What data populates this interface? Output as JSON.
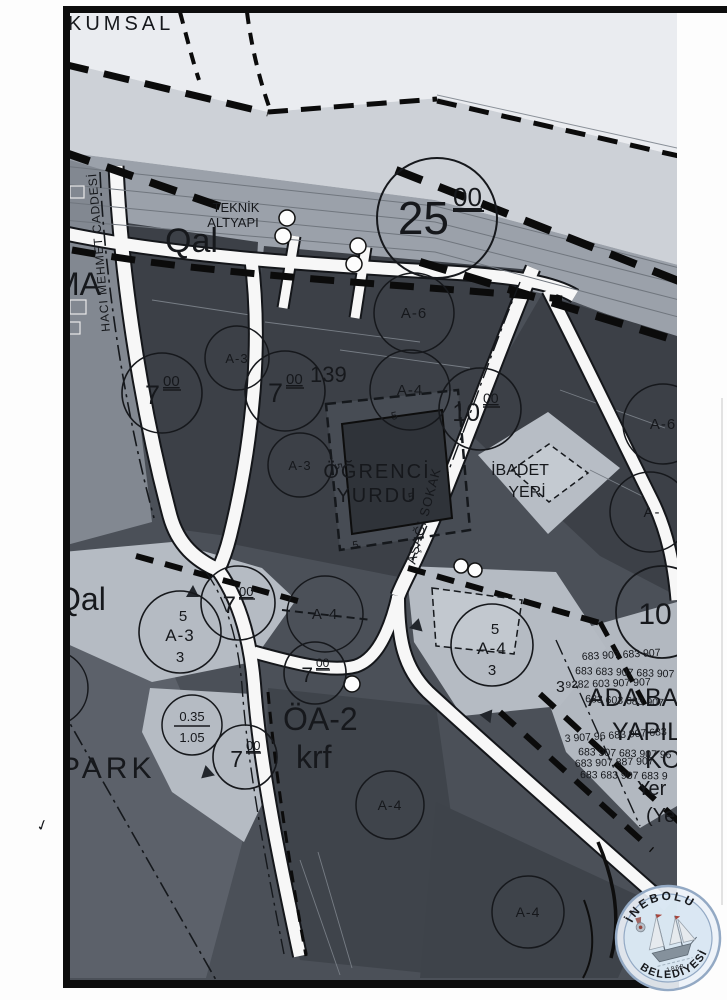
{
  "palette": {
    "sea": "#eaecf0",
    "shore": "#cdd1d7",
    "road_band": "#9ba1aa",
    "fabric_dark": "#4b5058",
    "block_dark": "#3c4047",
    "parcel_light": "#b5bbc3",
    "road_white": "#f7f7f7",
    "ink": "#16181c",
    "stamp_blue": "#3f68a8",
    "stamp_fill": "#d7e5f2"
  },
  "map": {
    "area_labels": {
      "kumsal": "KUMSAL",
      "ma": "MA",
      "qal_top": "Qal",
      "qal_left": "Qal",
      "teknik_1": "TEKNİK",
      "teknik_2": "ALTYAPI",
      "block_no": "139",
      "dorm_1": "ÖĞRENCİ",
      "dorm_2": "YURDU",
      "ibadet_1": "İBADET",
      "ibadet_2": "YERİ",
      "park": "PARK",
      "oa2": "ÖA-2",
      "krf": "krf",
      "ada_1": "ADA BA",
      "ada_2": "YAPIL",
      "ada_3": "KO",
      "yer_1": "Yer",
      "yer_2": "(Ye"
    },
    "street_labels": {
      "haci_mehmet": "HACI MEHMET CADDESİ",
      "asagi_sokak": "AŞAĞI SOKAK"
    },
    "circles": {
      "width": [
        {
          "main": "25",
          "sup": "00"
        },
        {
          "main": "7",
          "sup": "00"
        },
        {
          "main": "7",
          "sup": "00"
        },
        {
          "main": "10",
          "sup": "00"
        },
        {
          "main": "7",
          "sup": "00"
        },
        {
          "main": "7",
          "sup": "00"
        },
        {
          "main": "7",
          "sup": "00"
        },
        {
          "main": "10",
          "sup": ""
        }
      ],
      "parcel": [
        {
          "label": "A-3"
        },
        {
          "label": "A-3"
        },
        {
          "label": "A-6"
        },
        {
          "label": "A-4"
        },
        {
          "label": "A-6"
        },
        {
          "label": "A-"
        },
        {
          "label": "A-4"
        },
        {
          "label": "A-4"
        },
        {
          "label": "A-4"
        },
        {
          "label": "2"
        }
      ],
      "stack": [
        {
          "top": "5",
          "mid": "A-3",
          "bot": "3"
        },
        {
          "top": "5",
          "mid": "A-4",
          "bot": "3"
        }
      ],
      "ratio": [
        {
          "top": "0.35",
          "bot": "1.05"
        }
      ]
    },
    "small_numbers": [
      {
        "text": "5"
      },
      {
        "text": "5"
      },
      {
        "text": "5"
      },
      {
        "text": "5"
      },
      {
        "text": "3⁹²"
      }
    ],
    "number_jumble": [
      "683 907 683 907",
      "683 683 907 683 907",
      "282 603 907 907",
      "683 603 683 907",
      "3 907 96 683 907 683",
      "683 907 683 907 96",
      "683 907 887 907",
      "683 683 907 683 9"
    ],
    "margin_mark": "✓"
  },
  "stamp": {
    "top_text": "İNEBOLU",
    "bottom_text": "BELEDİYESİ",
    "year": "1868"
  }
}
